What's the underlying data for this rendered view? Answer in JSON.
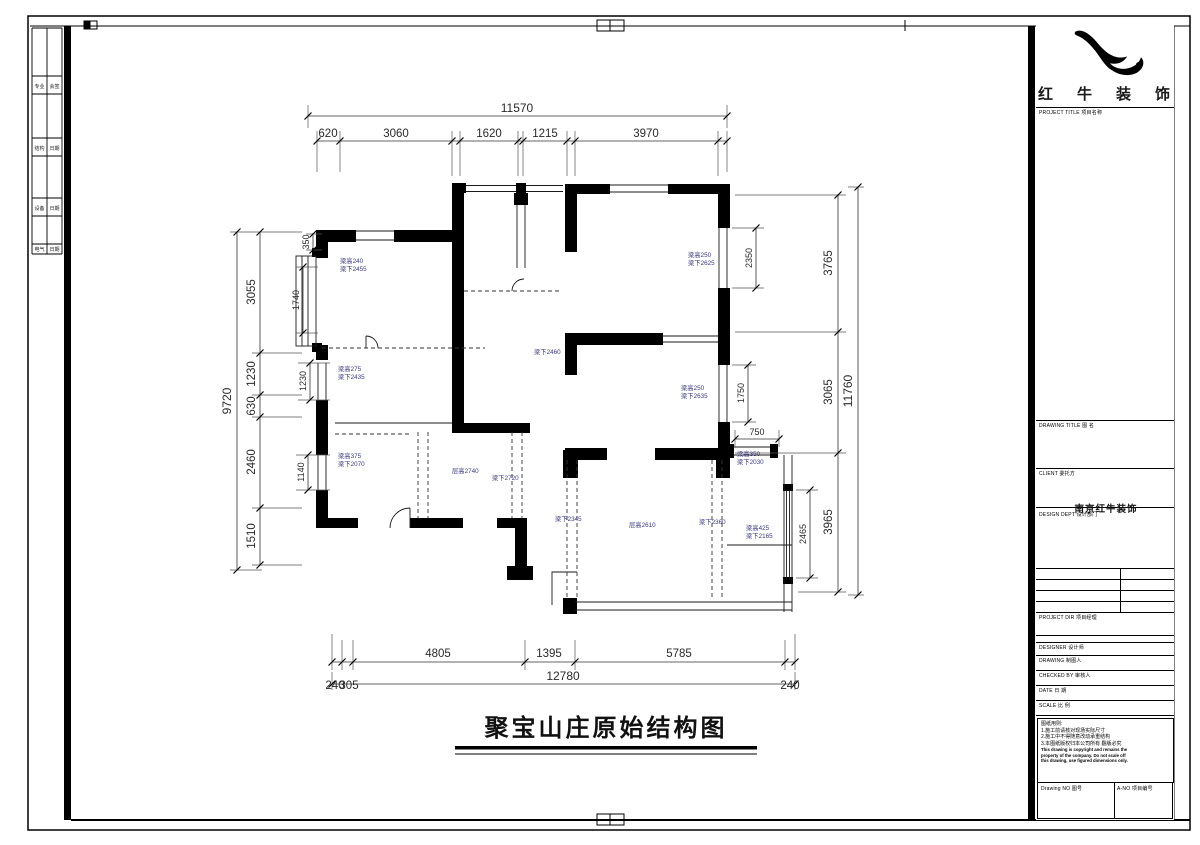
{
  "sheet": {
    "title": "聚宝山庄原始结构图"
  },
  "company": {
    "chars": [
      "红",
      "牛",
      "装",
      "饰"
    ],
    "full_name": "南京红牛装饰"
  },
  "title_block": {
    "project_title_label": "PROJECT TITLE 项目名称",
    "drawing_title_label": "DRAWING TITLE 图 名",
    "client_label": "CLIENT 委托方",
    "dept_label": "DESIGN DEPT 设计部门",
    "project_dir_label": "PROJECT DIR 项目经理",
    "designer_label": "DESIGNER 设计师",
    "drawing_label": "DRAWING 制图人",
    "checked_label": "CHECKED BY 审核人",
    "date_label": "DATE 日 期",
    "scale_label": "SCALE 比 例",
    "drawing_no_label": "Drawing NO 图号",
    "a_no_label": "A-NO 项目编号",
    "notes": [
      "图纸用则:",
      "1.施工前请核对现场实际尺寸",
      "2.施工中不得随意改动承重结构",
      "3.本图纸版权归本公司所有 翻版必究",
      "This drawing is copyright and remains the",
      "property of the company. Do not scale off",
      "this drawing, use figured dimensions only."
    ]
  },
  "sign_strip": {
    "rows": [
      {
        "c1": "专业",
        "c2": "会签"
      },
      {
        "c1": "结构",
        "c2": "日期"
      },
      {
        "c1": "设备",
        "c2": "日期"
      },
      {
        "c1": "电气",
        "c2": "日期"
      }
    ]
  },
  "dims": {
    "top_total": "11570",
    "top_segments": [
      "620",
      "3060",
      "1620",
      "1215",
      "3970"
    ],
    "left_total": "9720",
    "left_segments": [
      "3055",
      "1230",
      "630",
      "2460",
      "1510"
    ],
    "right_total": "11760",
    "right_segments": [
      "3765",
      "3065",
      "3965"
    ],
    "bottom_segments": [
      "4805",
      "1395",
      "5785"
    ],
    "bottom_total": "12780",
    "bottom_left_a": "240",
    "bottom_left_b": "305",
    "bottom_right": "240",
    "win_350": "350",
    "win_1740": "1740",
    "win_1230": "1230",
    "win_1140": "1140",
    "win_2350": "2350",
    "win_1750": "1750",
    "win_2465": "2465",
    "win_750": "750"
  },
  "plan_labels": [
    {
      "t1": "梁高240",
      "t2": "梁下2455"
    },
    {
      "t1": "梁高250",
      "t2": "梁下2625"
    },
    {
      "t1": "梁高275",
      "t2": "梁下2435"
    },
    {
      "t1": "梁高250",
      "t2": "梁下2635"
    },
    {
      "t1": "梁高375",
      "t2": "梁下2070"
    },
    {
      "t1": "层高2740",
      "t2": ""
    },
    {
      "t1": "梁下2720",
      "t2": ""
    },
    {
      "t1": "梁高350",
      "t2": "梁下2030"
    },
    {
      "t1": "梁下2345",
      "t2": ""
    },
    {
      "t1": "层高2610",
      "t2": ""
    },
    {
      "t1": "梁下2360",
      "t2": ""
    },
    {
      "t1": "梁高425",
      "t2": "梁下2165"
    },
    {
      "t1": "梁下2460",
      "t2": ""
    }
  ]
}
